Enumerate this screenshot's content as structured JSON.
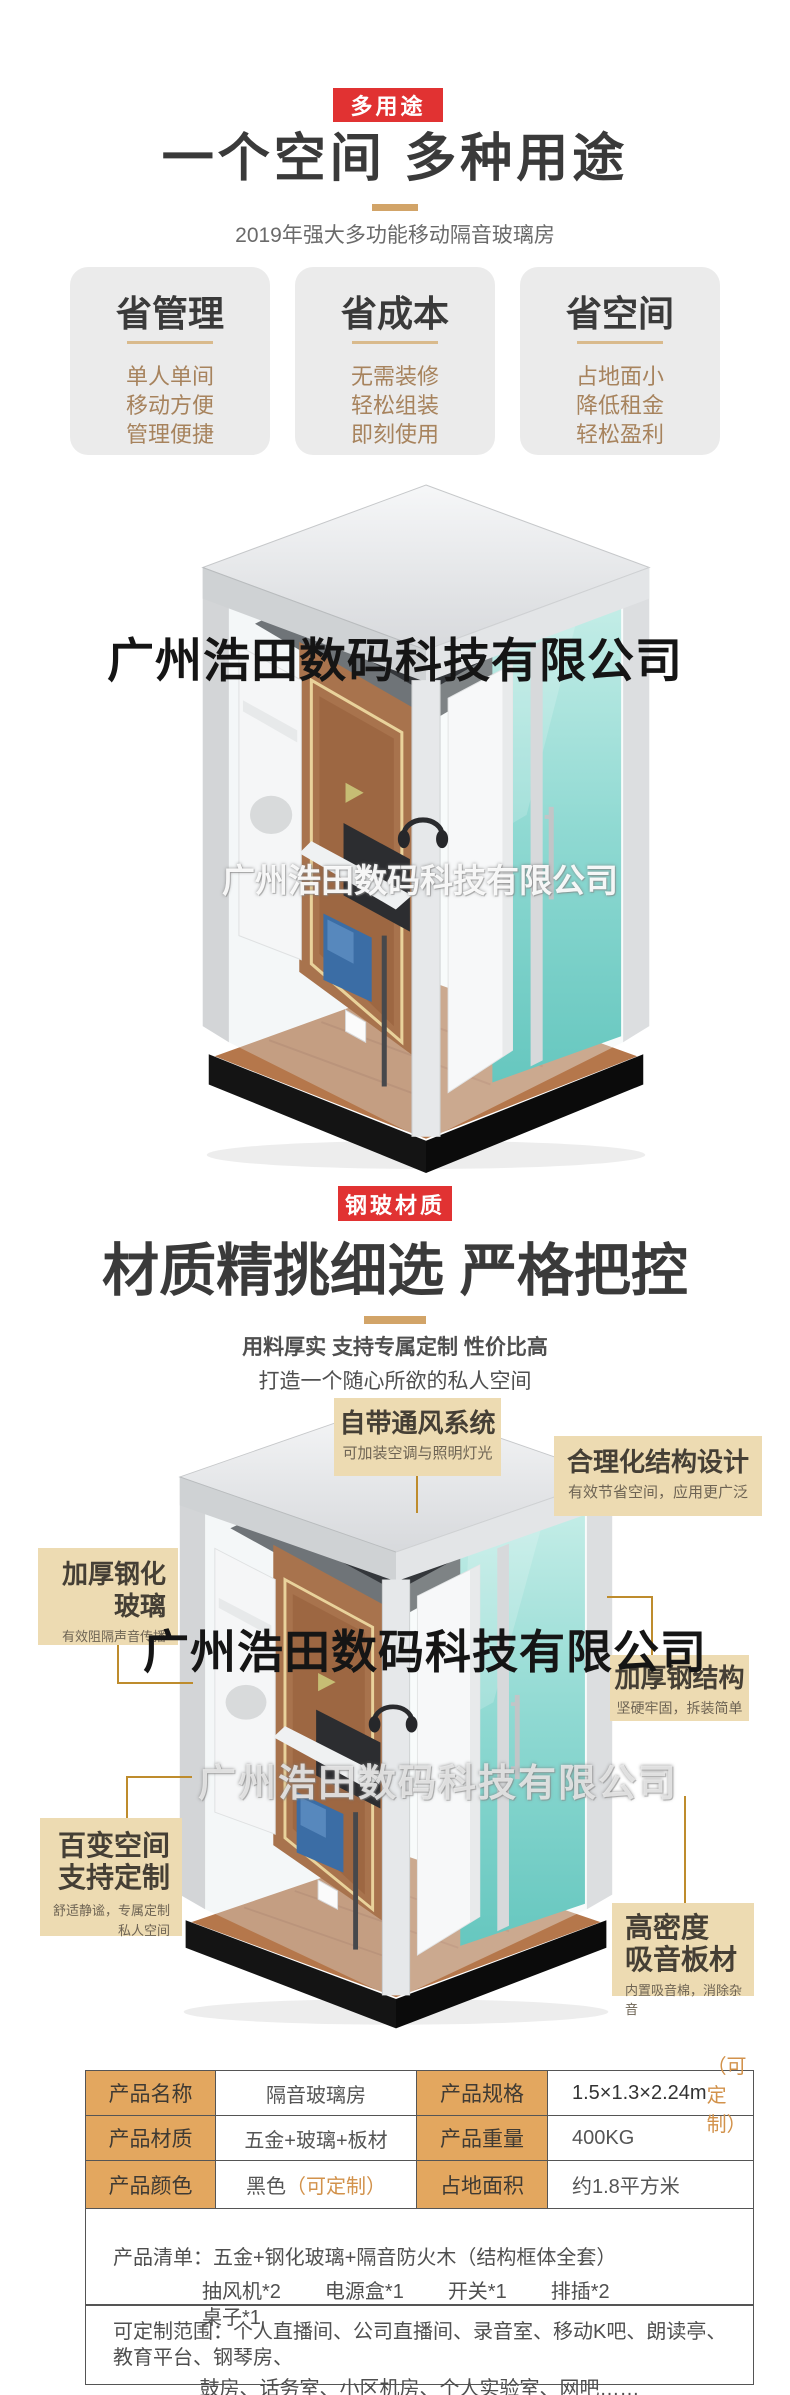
{
  "colors": {
    "badge_red": "#E13232",
    "gold_accent": "#D2A468",
    "callout_bg": "#EDDBB2",
    "pointer_gold": "#BE8C2D",
    "table_label_bg": "#E3A75F",
    "gold_text": "#D2924B",
    "card_text_brown": "#A7835D"
  },
  "watermark": {
    "company": "广州浩田数码科技有限公司"
  },
  "section_multiuse": {
    "badge": "多用途",
    "title": "一个空间 多种用途",
    "subtitle": "2019年强大多功能移动隔音玻璃房",
    "cards": [
      {
        "title": "省管理",
        "items": [
          "单人单间",
          "移动方便",
          "管理便捷"
        ]
      },
      {
        "title": "省成本",
        "items": [
          "无需装修",
          "轻松组装",
          "即刻使用"
        ]
      },
      {
        "title": "省空间",
        "items": [
          "占地面小",
          "降低租金",
          "轻松盈利"
        ]
      }
    ]
  },
  "section_material": {
    "badge": "钢玻材质",
    "title": "材质精挑细选 严格把控",
    "subtitle_line1": "用料厚实 支持专属定制 性价比高",
    "subtitle_line2": "打造一个随心所欲的私人空间",
    "callouts": {
      "ventilation": {
        "title": "自带通风系统",
        "desc": "可加装空调与照明灯光"
      },
      "structure": {
        "title": "合理化结构设计",
        "desc": "有效节省空间，应用更广泛"
      },
      "glass": {
        "title_line1": "加厚钢化",
        "title_line2": "玻璃",
        "desc": "有效阻隔声音传播"
      },
      "steel": {
        "title": "加厚钢结构",
        "desc": "坚硬牢固，拆装简单"
      },
      "space": {
        "title_line1": "百变空间",
        "title_line2": "支持定制",
        "desc_line1": "舒适静谧，专属定制",
        "desc_line2": "私人空间"
      },
      "soundboard": {
        "title_line1": "高密度",
        "title_line2": "吸音板材",
        "desc": "内置吸音棉，消除杂音"
      }
    }
  },
  "spec_table": {
    "rows": [
      {
        "label1": "产品名称",
        "value1": "隔音玻璃房",
        "value1_note": "",
        "label2": "产品规格",
        "value2": "1.5×1.3×2.24m",
        "value2_note": "（可定制）"
      },
      {
        "label1": "产品材质",
        "value1": "五金+玻璃+板材",
        "value1_note": "",
        "label2": "产品重量",
        "value2": "400KG",
        "value2_note": ""
      },
      {
        "label1": "产品颜色",
        "value1": "黑色",
        "value1_note": "（可定制）",
        "label2": "占地面积",
        "value2": "约1.8平方米",
        "value2_note": ""
      }
    ],
    "list_label": "产品清单：",
    "list_main": "五金+钢化玻璃+隔音防火木（结构框体全套）",
    "list_items": [
      "抽风机*2",
      "电源盒*1",
      "开关*1",
      "排插*2",
      "桌子*1"
    ],
    "custom_label": "可定制范围：",
    "custom_line1": "个人直播间、公司直播间、录音室、移动K吧、朗读亭、教育平台、钢琴房、",
    "custom_line2": "鼓房、话务室、小区机房、个人实验室、网吧……"
  }
}
